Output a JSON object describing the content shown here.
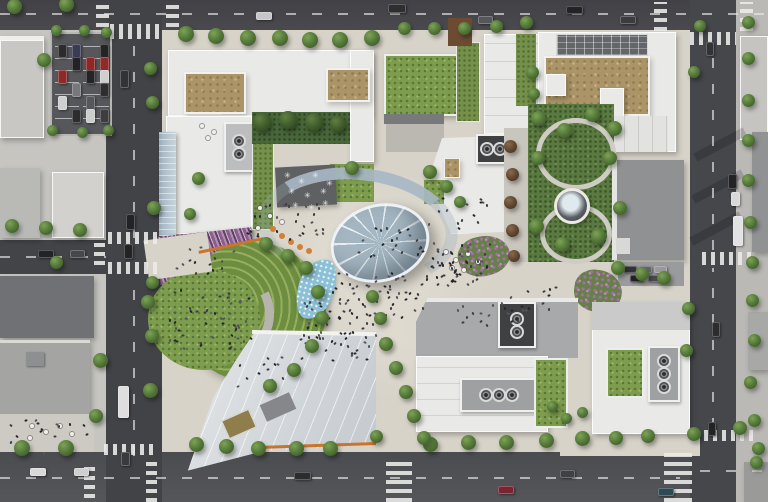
{
  "scene": {
    "description": "Aerial rendering of an urban mixed-use campus: city blocks with white buildings and green roofs, a surface parking lot, a central plaza with an elliptical glass canopy dome, a curved glass walkway canopy, a terraced crescent amphitheater with purple planting beds, an eastern pocket park with a circular fountain, tree-lined streets with crosswalks, cars and pedestrians",
    "palette": {
      "asphalt": "#48484c",
      "asphalt_dark": "#3f4044",
      "sidewalk": "#c6c5c0",
      "campus_paving": "#d7d3c9",
      "roof_white": "#e9e9e7",
      "roof_gray": "#8f9193",
      "roof_dark": "#6f7174",
      "tan_roof": "#ab9568",
      "lawn_green": "#7d9c4e",
      "park_green": "#5b7a41",
      "tree_green": "#55793a",
      "glass_blue": "#9fb3c0",
      "purple_terrace": "#8a5f8e",
      "water_blue": "#8cc0d6",
      "orange_accent": "#c9752c",
      "crosswalk_white": "#ececea",
      "parking_asphalt": "#56575b",
      "people_dark": "#26262a"
    },
    "trees": [
      [
        14,
        6,
        15
      ],
      [
        66,
        4,
        15
      ],
      [
        186,
        34,
        16
      ],
      [
        216,
        36,
        16
      ],
      [
        248,
        38,
        16
      ],
      [
        280,
        38,
        16
      ],
      [
        310,
        40,
        16
      ],
      [
        340,
        40,
        16
      ],
      [
        372,
        38,
        16
      ],
      [
        404,
        28,
        13
      ],
      [
        434,
        28,
        13
      ],
      [
        464,
        28,
        13
      ],
      [
        496,
        26,
        13
      ],
      [
        526,
        22,
        13
      ],
      [
        700,
        26,
        12
      ],
      [
        748,
        22,
        13
      ],
      [
        44,
        60,
        14
      ],
      [
        150,
        68,
        13
      ],
      [
        152,
        102,
        13
      ],
      [
        154,
        208,
        14
      ],
      [
        198,
        178,
        13
      ],
      [
        190,
        214,
        12
      ],
      [
        56,
        30,
        11
      ],
      [
        84,
        30,
        11
      ],
      [
        106,
        32,
        11
      ],
      [
        52,
        130,
        11
      ],
      [
        82,
        132,
        11
      ],
      [
        108,
        130,
        11
      ],
      [
        12,
        226,
        14
      ],
      [
        46,
        228,
        14
      ],
      [
        80,
        230,
        14
      ],
      [
        56,
        262,
        13
      ],
      [
        100,
        360,
        15
      ],
      [
        148,
        302,
        14
      ],
      [
        152,
        336,
        14
      ],
      [
        150,
        390,
        15
      ],
      [
        22,
        448,
        16
      ],
      [
        66,
        448,
        16
      ],
      [
        96,
        416,
        14
      ],
      [
        196,
        444,
        15
      ],
      [
        226,
        446,
        15
      ],
      [
        258,
        448,
        15
      ],
      [
        296,
        448,
        15
      ],
      [
        330,
        448,
        15
      ],
      [
        430,
        444,
        15
      ],
      [
        468,
        442,
        15
      ],
      [
        506,
        442,
        15
      ],
      [
        546,
        440,
        15
      ],
      [
        582,
        438,
        15
      ],
      [
        616,
        438,
        14
      ],
      [
        648,
        436,
        14
      ],
      [
        694,
        434,
        14
      ],
      [
        740,
        428,
        14
      ],
      [
        758,
        448,
        13
      ],
      [
        748,
        58,
        13
      ],
      [
        748,
        100,
        13
      ],
      [
        748,
        140,
        13
      ],
      [
        748,
        180,
        13
      ],
      [
        750,
        222,
        13
      ],
      [
        752,
        262,
        13
      ],
      [
        752,
        300,
        13
      ],
      [
        754,
        340,
        13
      ],
      [
        750,
        382,
        13
      ],
      [
        754,
        420,
        13
      ],
      [
        756,
        462,
        13
      ],
      [
        694,
        72,
        12
      ],
      [
        688,
        308,
        13
      ],
      [
        686,
        350,
        13
      ],
      [
        262,
        122,
        18,
        "d"
      ],
      [
        288,
        120,
        18,
        "d"
      ],
      [
        314,
        122,
        18,
        "d"
      ],
      [
        338,
        124,
        16,
        "d"
      ],
      [
        352,
        168,
        14
      ],
      [
        430,
        172,
        14
      ],
      [
        446,
        186,
        13
      ],
      [
        460,
        202,
        12
      ],
      [
        510,
        146,
        13,
        "b"
      ],
      [
        512,
        174,
        13,
        "b"
      ],
      [
        510,
        202,
        13,
        "b"
      ],
      [
        512,
        230,
        13,
        "b"
      ],
      [
        514,
        256,
        12,
        "b"
      ],
      [
        538,
        118,
        15
      ],
      [
        564,
        130,
        15
      ],
      [
        592,
        114,
        15
      ],
      [
        614,
        128,
        15
      ],
      [
        538,
        158,
        14
      ],
      [
        610,
        158,
        14
      ],
      [
        536,
        226,
        15
      ],
      [
        562,
        244,
        15
      ],
      [
        598,
        236,
        15
      ],
      [
        620,
        208,
        14
      ],
      [
        618,
        268,
        14
      ],
      [
        642,
        274,
        14
      ],
      [
        664,
        278,
        14
      ],
      [
        552,
        406,
        11
      ],
      [
        566,
        418,
        11
      ],
      [
        582,
        412,
        11
      ],
      [
        386,
        344,
        14
      ],
      [
        396,
        368,
        14
      ],
      [
        406,
        392,
        14
      ],
      [
        414,
        416,
        14
      ],
      [
        424,
        438,
        14
      ],
      [
        376,
        436,
        13
      ],
      [
        380,
        318,
        13
      ],
      [
        372,
        296,
        13
      ],
      [
        266,
        244,
        14
      ],
      [
        288,
        256,
        14
      ],
      [
        306,
        268,
        14
      ],
      [
        318,
        292,
        14
      ],
      [
        322,
        318,
        14
      ],
      [
        312,
        346,
        14
      ],
      [
        294,
        370,
        14
      ],
      [
        270,
        386,
        14
      ],
      [
        152,
        282,
        13
      ],
      [
        532,
        72,
        13
      ],
      [
        534,
        94,
        12
      ]
    ],
    "cars": [
      [
        256,
        12,
        14,
        6,
        "#c6c6c8"
      ],
      [
        388,
        4,
        16,
        7,
        "#2e2e31"
      ],
      [
        566,
        6,
        15,
        6,
        "#232326"
      ],
      [
        620,
        16,
        14,
        6,
        "#3c3c40"
      ],
      [
        478,
        16,
        13,
        6,
        "#54565a"
      ],
      [
        58,
        44,
        7,
        12,
        "#2c2c2e"
      ],
      [
        58,
        70,
        7,
        12,
        "#8a2a2a"
      ],
      [
        58,
        96,
        7,
        12,
        "#cfcfcf"
      ],
      [
        72,
        44,
        7,
        12,
        "#3b3b55"
      ],
      [
        72,
        57,
        7,
        12,
        "#222226"
      ],
      [
        72,
        83,
        7,
        12,
        "#77787a"
      ],
      [
        72,
        109,
        7,
        12,
        "#2c2c2e"
      ],
      [
        86,
        57,
        7,
        12,
        "#912626"
      ],
      [
        86,
        70,
        7,
        12,
        "#242426"
      ],
      [
        86,
        96,
        7,
        12,
        "#56575b"
      ],
      [
        86,
        109,
        7,
        12,
        "#cccccc"
      ],
      [
        100,
        44,
        7,
        12,
        "#242426"
      ],
      [
        100,
        57,
        7,
        12,
        "#8e2b2b"
      ],
      [
        100,
        70,
        7,
        12,
        "#cfcfcf"
      ],
      [
        100,
        83,
        7,
        12,
        "#2e2e30"
      ],
      [
        100,
        109,
        7,
        12,
        "#3d3d3f"
      ],
      [
        120,
        70,
        7,
        16,
        "#333336"
      ],
      [
        126,
        214,
        7,
        14,
        "#232326"
      ],
      [
        124,
        244,
        7,
        13,
        "#232326"
      ],
      [
        118,
        386,
        9,
        30,
        "#dedede"
      ],
      [
        121,
        452,
        7,
        12,
        "#3a3a3e"
      ],
      [
        38,
        250,
        14,
        6,
        "#232326"
      ],
      [
        70,
        250,
        13,
        6,
        "#47474b"
      ],
      [
        30,
        468,
        14,
        6,
        "#d8d8d8"
      ],
      [
        74,
        468,
        13,
        6,
        "#cfcfcf"
      ],
      [
        294,
        472,
        15,
        6,
        "#2c2c2f"
      ],
      [
        498,
        486,
        14,
        6,
        "#7b2330"
      ],
      [
        560,
        470,
        13,
        6,
        "#404044"
      ],
      [
        658,
        488,
        14,
        6,
        "#2c4a52"
      ],
      [
        706,
        42,
        6,
        12,
        "#333336"
      ],
      [
        728,
        174,
        7,
        13,
        "#232326"
      ],
      [
        731,
        192,
        7,
        12,
        "#d8d8d8"
      ],
      [
        733,
        216,
        8,
        28,
        "#e2e2e2"
      ],
      [
        712,
        322,
        6,
        13,
        "#2c2c2f"
      ],
      [
        708,
        422,
        6,
        12,
        "#232326"
      ],
      [
        624,
        266,
        11,
        5,
        "#333336"
      ],
      [
        639,
        266,
        11,
        5,
        "#66676a"
      ],
      [
        654,
        266,
        11,
        5,
        "#99999b"
      ],
      [
        630,
        275,
        11,
        5,
        "#232326"
      ],
      [
        648,
        275,
        11,
        5,
        "#4b4b4f"
      ]
    ],
    "crosswalks": [
      [
        110,
        24,
        52,
        15,
        "v"
      ],
      [
        96,
        2,
        13,
        25,
        "h"
      ],
      [
        166,
        2,
        13,
        25,
        "h"
      ],
      [
        654,
        2,
        13,
        29,
        "h"
      ],
      [
        740,
        2,
        13,
        29,
        "h"
      ],
      [
        690,
        32,
        46,
        13,
        "v"
      ],
      [
        108,
        232,
        54,
        12,
        "v"
      ],
      [
        108,
        262,
        54,
        12,
        "v"
      ],
      [
        94,
        241,
        11,
        24,
        "h"
      ],
      [
        104,
        444,
        50,
        11,
        "v"
      ],
      [
        84,
        462,
        11,
        36,
        "h"
      ],
      [
        146,
        462,
        11,
        40,
        "h"
      ],
      [
        386,
        458,
        26,
        44,
        "h"
      ],
      [
        664,
        452,
        28,
        50,
        "h"
      ],
      [
        702,
        252,
        54,
        13,
        "v"
      ],
      [
        704,
        430,
        52,
        11,
        "v"
      ]
    ],
    "lanes": [
      [
        0,
        13,
        766,
        2,
        "x"
      ],
      [
        0,
        477,
        680,
        2,
        "x"
      ],
      [
        700,
        470,
        68,
        2,
        "x"
      ],
      [
        133,
        32,
        2,
        206,
        "y"
      ],
      [
        133,
        276,
        2,
        180,
        "y"
      ],
      [
        712,
        48,
        2,
        202,
        "y"
      ],
      [
        712,
        268,
        2,
        160,
        "y"
      ],
      [
        0,
        256,
        106,
        2,
        "x"
      ]
    ],
    "people_clusters": [
      [
        332,
        272,
        95,
        45,
        55
      ],
      [
        356,
        226,
        66,
        30,
        22
      ],
      [
        246,
        196,
        80,
        42,
        28
      ],
      [
        298,
        298,
        85,
        48,
        40
      ],
      [
        424,
        196,
        64,
        88,
        40
      ],
      [
        166,
        288,
        85,
        60,
        50
      ],
      [
        300,
        330,
        75,
        30,
        20
      ],
      [
        428,
        242,
        62,
        36,
        26
      ],
      [
        8,
        416,
        84,
        36,
        20
      ],
      [
        176,
        246,
        64,
        26,
        14
      ],
      [
        452,
        300,
        70,
        26,
        16
      ],
      [
        236,
        356,
        60,
        30,
        14
      ],
      [
        508,
        286,
        50,
        24,
        12
      ]
    ],
    "tables": [
      [
        444,
        250
      ],
      [
        454,
        258
      ],
      [
        466,
        252
      ],
      [
        476,
        260
      ],
      [
        450,
        266
      ],
      [
        462,
        268
      ],
      [
        258,
        206
      ],
      [
        268,
        214
      ],
      [
        280,
        220
      ],
      [
        256,
        226
      ],
      [
        30,
        424
      ],
      [
        44,
        430
      ],
      [
        58,
        424
      ],
      [
        28,
        436
      ],
      [
        70,
        432
      ],
      [
        200,
        124
      ],
      [
        212,
        130
      ],
      [
        206,
        136
      ]
    ],
    "stars": {
      "glyph": "✳",
      "points": [
        [
          284,
          172
        ],
        [
          298,
          178
        ],
        [
          312,
          172
        ],
        [
          326,
          180
        ],
        [
          288,
          188
        ],
        [
          304,
          192
        ],
        [
          320,
          188
        ],
        [
          292,
          202
        ],
        [
          308,
          204
        ],
        [
          322,
          200
        ]
      ]
    }
  }
}
